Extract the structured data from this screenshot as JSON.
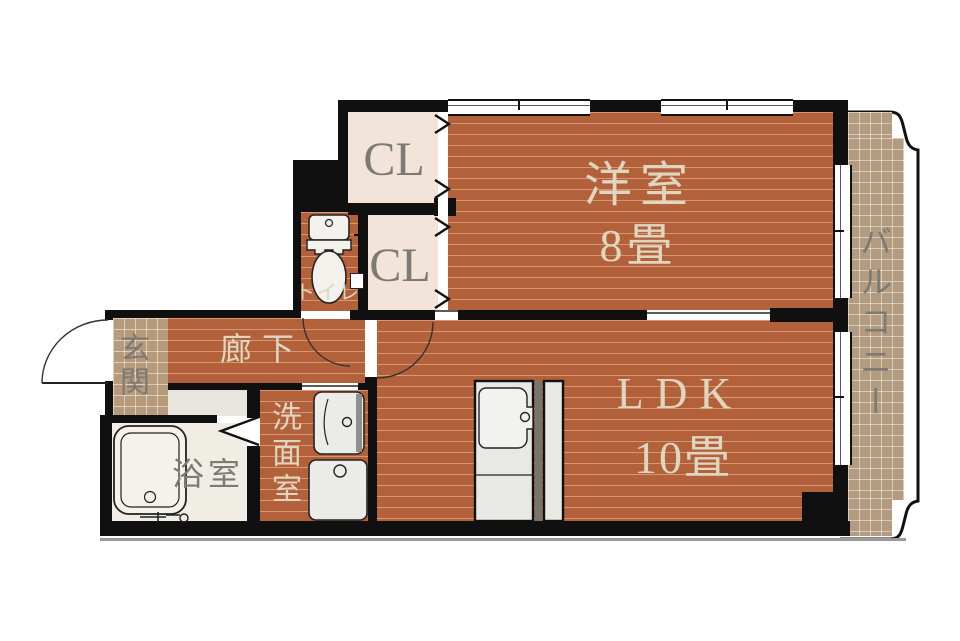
{
  "plan_title": "1LDK floor plan",
  "rooms": {
    "youshitsu": {
      "name": "洋室",
      "size": "8畳"
    },
    "ldk": {
      "name": "LDK",
      "size": "10畳"
    },
    "closet_upper": {
      "name": "CL"
    },
    "closet_lower": {
      "name": "CL"
    },
    "toilet": {
      "name": "トイレ"
    },
    "genkan": {
      "name": "玄関"
    },
    "hallway": {
      "name": "廊下"
    },
    "bathroom": {
      "name": "浴室"
    },
    "washroom": {
      "name": "洗面室"
    },
    "balcony": {
      "name": "バルコニー"
    }
  },
  "colors": {
    "wood_floor": "#b2613a",
    "tile_floor": "#b59a7c",
    "closet_floor": "#f2e4d8",
    "bathroom_floor": "#f0ede4",
    "wall": "#101010",
    "label_cream": "#ded6c0",
    "label_gray": "#7c7a74"
  }
}
